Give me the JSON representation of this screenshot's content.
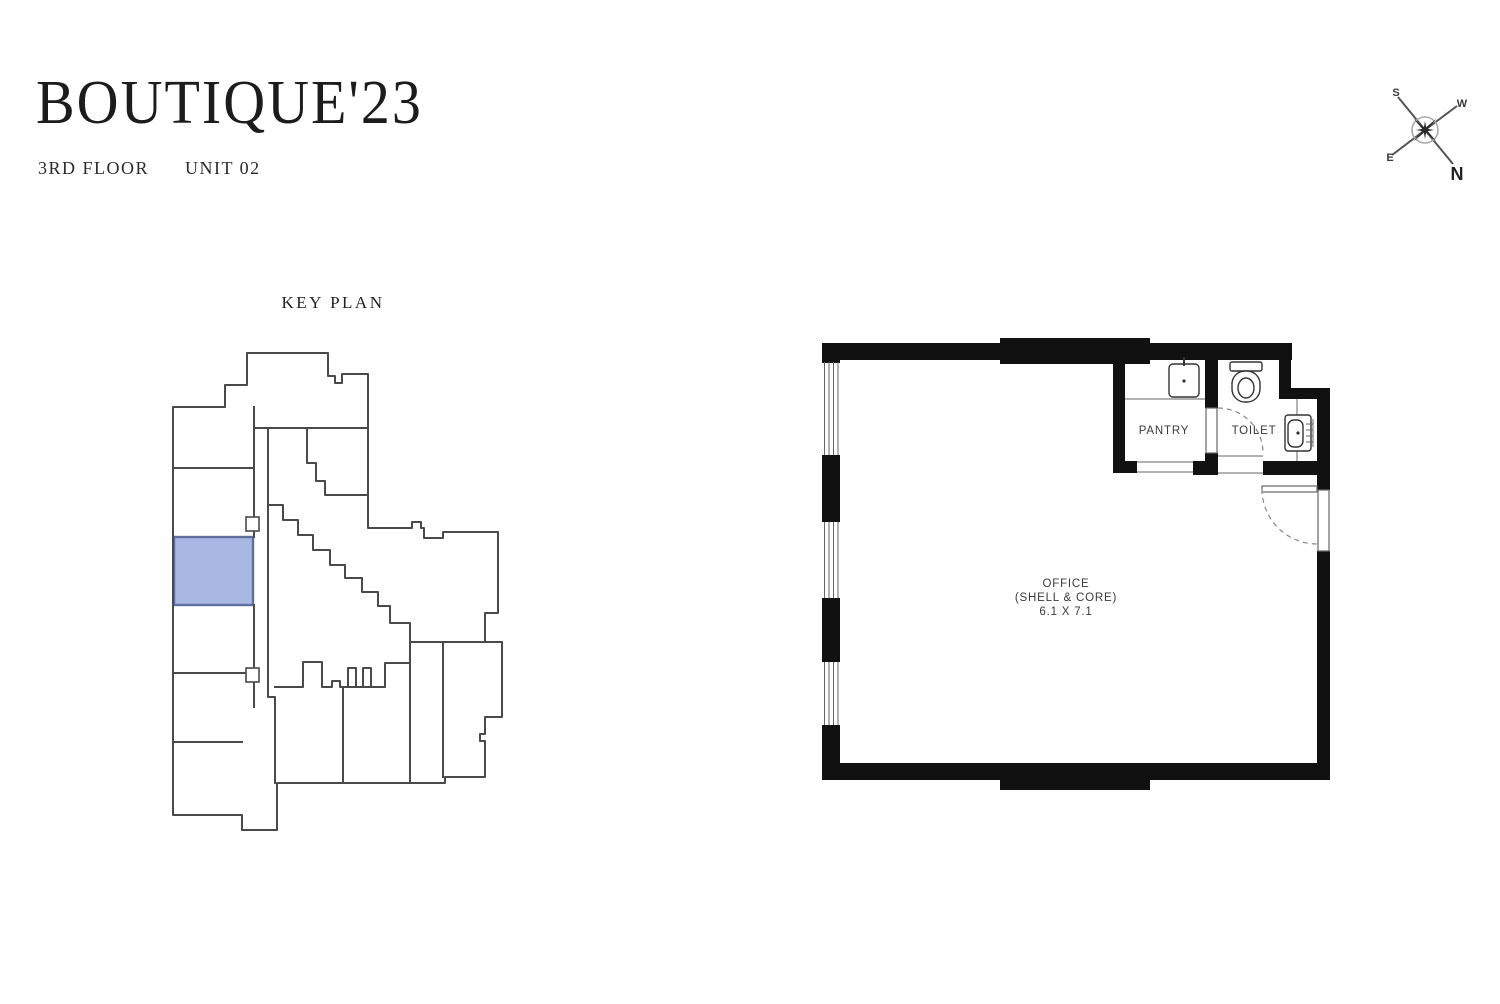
{
  "header": {
    "title": "BOUTIQUE'23",
    "floor": "3RD FLOOR",
    "unit": "UNIT 02"
  },
  "key_plan": {
    "title": "KEY PLAN",
    "highlighted_unit": "UNIT 02",
    "highlight_color": "#a8b8e2",
    "highlight_border_color": "#5d6e9d",
    "outline_color": "#4a4a4a"
  },
  "floor_plan": {
    "wall_color": "#111111",
    "rooms": {
      "office": {
        "name": "OFFICE",
        "subtitle": "(SHELL & CORE)",
        "dimensions": "6.1 X 7.1"
      },
      "pantry": {
        "name": "PANTRY"
      },
      "toilet": {
        "name": "TOILET"
      }
    }
  },
  "compass": {
    "north": "N",
    "south": "S",
    "east": "E",
    "west": "W"
  }
}
